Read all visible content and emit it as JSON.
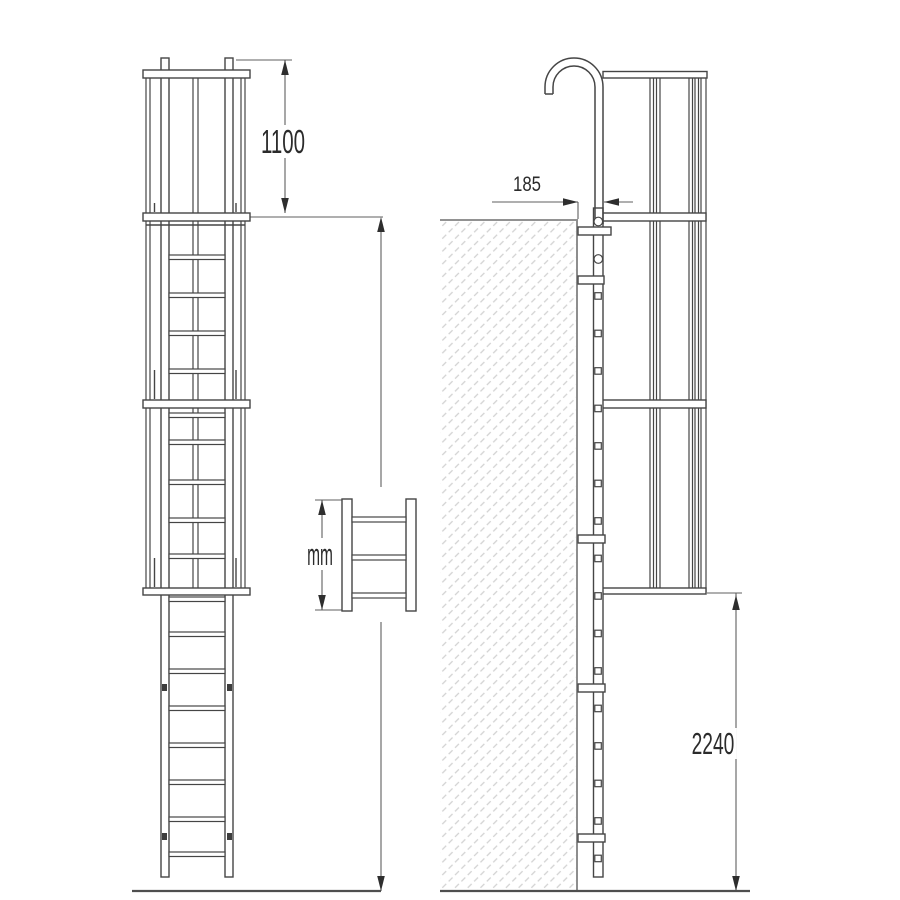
{
  "dimension_labels": {
    "cage_top": "1100",
    "wall_offset": "185",
    "height_unit": "mm",
    "lower_clearance": "2240"
  },
  "colors": {
    "background": "#ffffff",
    "structure_line": "#454545",
    "dimension_line": "#5f5f5f",
    "arrow": "#2e2e2e",
    "text": "#2b2b2b",
    "wall_hatch": "#d2d2d2",
    "wall_edge": "#8e8e8e"
  }
}
